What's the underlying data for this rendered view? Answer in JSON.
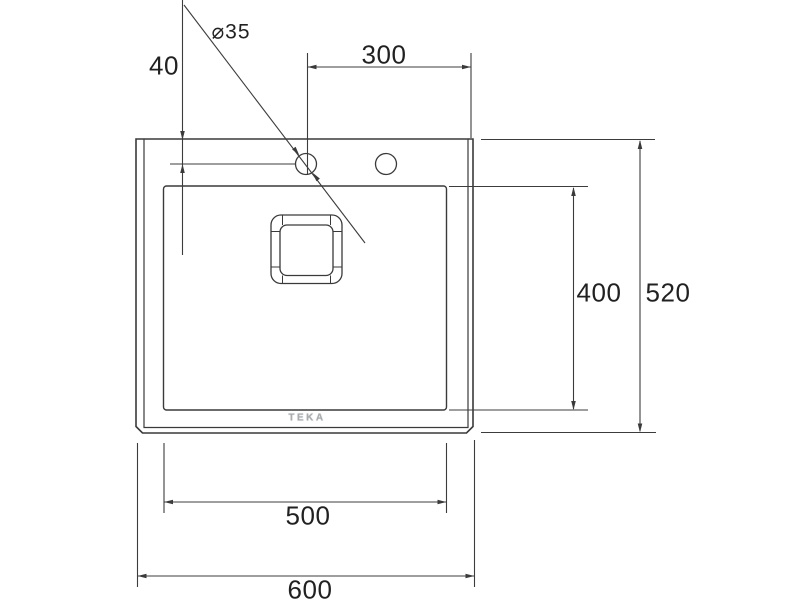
{
  "drawing": {
    "brand": "TEKA",
    "labels": {
      "hole_offset_top": "40",
      "hole_diameter": "⌀35",
      "hole_to_right_edge": "300",
      "bowl_length": "400",
      "overall_length": "520",
      "bowl_width": "500",
      "overall_width": "600"
    },
    "colors": {
      "line": "#3a3a3a",
      "text": "#212121",
      "logo": "#a9adb0",
      "background": "#ffffff"
    }
  }
}
